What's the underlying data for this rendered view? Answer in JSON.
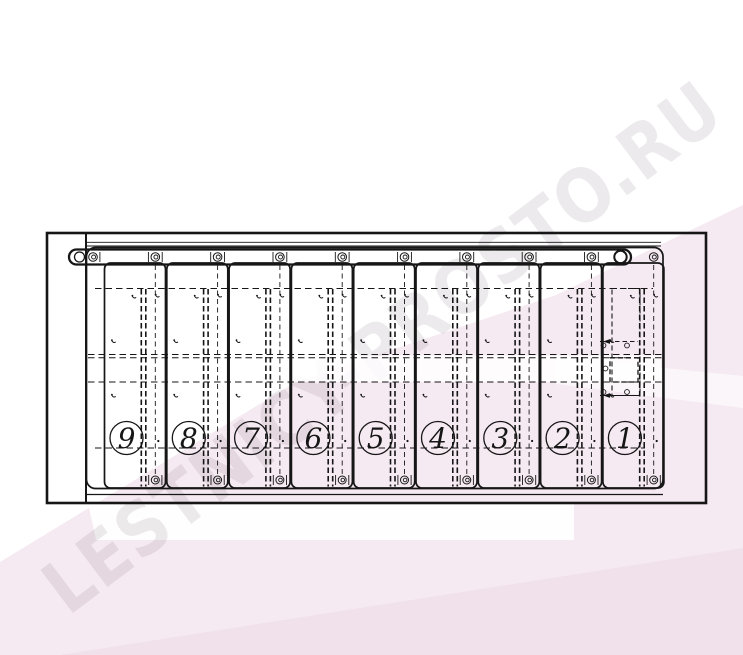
{
  "watermark": {
    "text": "LESTNICY-PROSTO.RU"
  },
  "diagram": {
    "type": "technical-drawing",
    "description": "front view of fold-out 9-step unit",
    "panel_labels": [
      "9",
      "8",
      "7",
      "6",
      "5",
      "4",
      "3",
      "2",
      "1"
    ],
    "colors": {
      "line": "#161616",
      "pink": "#f6eaf2",
      "pink_dark": "#f1e1eb",
      "stripe": "rgba(255,255,255,0.55)",
      "wedge": "rgba(255,255,255,0.92)",
      "band": "rgba(255,255,255,0.85)",
      "watermark": "rgba(70,45,65,0.10)"
    }
  }
}
